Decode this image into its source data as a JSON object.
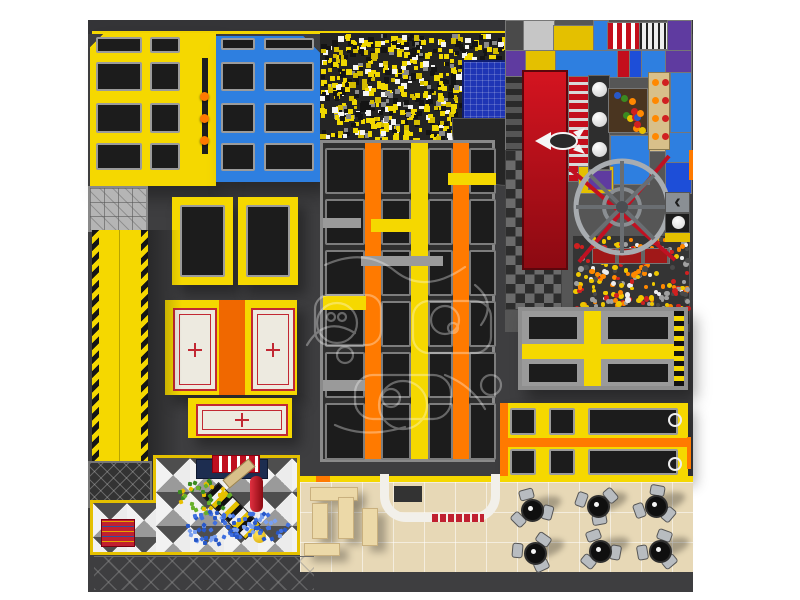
{
  "scene": {
    "title": "Indoor trampoline park with kids soft-play — top view 3D render",
    "canvas": {
      "width": 800,
      "height": 600,
      "background": "#ffffff"
    },
    "watermark": {
      "present": true,
      "description": "faint white outline cartoon logo overlay"
    }
  },
  "icons": {
    "chevron_left": "‹"
  },
  "palette": {
    "yellow": "#f5d800",
    "yellowDeep": "#e4c000",
    "orange": "#ff7a00",
    "orangeDeep": "#f06800",
    "blue": "#2e7fe0",
    "blueDeep": "#1d4ed8",
    "navy": "#1f35b5",
    "purple": "#5f3ba0",
    "red": "#c40e1c",
    "redDark": "#a01818",
    "silver": "#c6c6c6",
    "gray": "#9a9a9a",
    "grayLight": "#b5b5b5",
    "dim": "#4a4a4a",
    "bed": "#1c1c1c",
    "floor": "#3e3e40",
    "floorDark": "#343437",
    "beige": "#e7d8b6",
    "court": "#edeae0",
    "courtLine": "#c22833",
    "tan": "#d8c08a",
    "benchTan": "#ecd9a8",
    "white": "#f5f5f5"
  },
  "zones": {
    "yellow_block": {
      "label": "yellow wall trampolines",
      "x": 90,
      "y": 33,
      "w": 126,
      "h": 153,
      "cols": [
        [
          6,
          46
        ],
        [
          60,
          30
        ]
      ],
      "rows": [
        [
          4,
          16
        ],
        [
          29,
          29
        ],
        [
          70,
          30
        ],
        [
          110,
          27
        ]
      ]
    },
    "blue_block": {
      "label": "blue wall trampolines",
      "x": 216,
      "y": 36,
      "w": 104,
      "h": 146,
      "cols": [
        [
          5,
          34
        ],
        [
          48,
          50
        ]
      ],
      "rows": [
        [
          2,
          12
        ],
        [
          26,
          29
        ],
        [
          67,
          30
        ],
        [
          107,
          28
        ]
      ]
    },
    "orange_balls": [
      [
        200,
        92
      ],
      [
        200,
        114
      ],
      [
        200,
        136
      ]
    ],
    "foam_pit": {
      "label": "foam cube pit",
      "cube_count": 780,
      "cube_colors": [
        "#f0d800",
        "#d4bc00",
        "#141414",
        "#f5f5f5",
        "#8a8a8a"
      ],
      "cube_weights": [
        0.36,
        0.14,
        0.3,
        0.13,
        0.07
      ]
    },
    "main_court": {
      "label": "main trampoline court",
      "columns": 4,
      "rows": 6,
      "col_rects": [
        [
          2,
          40
        ],
        [
          58,
          30
        ],
        [
          105,
          25
        ],
        [
          146,
          27
        ]
      ],
      "beams": [
        [
          42,
          16,
          "orange"
        ],
        [
          88,
          17,
          "yellow"
        ],
        [
          130,
          16,
          "orange"
        ]
      ],
      "row_ys": [
        [
          5,
          46
        ],
        [
          56,
          46
        ],
        [
          107,
          46
        ],
        [
          158,
          46
        ],
        [
          209,
          46
        ],
        [
          260,
          57
        ]
      ],
      "pads": [
        [
          0,
          75,
          38,
          10,
          "gray"
        ],
        [
          48,
          76,
          52,
          13,
          "yellow"
        ],
        [
          38,
          113,
          82,
          10,
          "gray"
        ],
        [
          0,
          153,
          43,
          14,
          "yellow"
        ],
        [
          0,
          237,
          42,
          11,
          "gray"
        ],
        [
          125,
          30,
          48,
          12,
          "yellow"
        ]
      ]
    },
    "playground": {
      "label": "kids soft-play structure",
      "tiles": [
        [
          0,
          0,
          18,
          30,
          "dim"
        ],
        [
          18,
          0,
          30,
          30,
          "silver"
        ],
        [
          48,
          5,
          40,
          27,
          "yellowDeep"
        ],
        [
          88,
          0,
          14,
          30,
          "blue"
        ],
        [
          102,
          2,
          32,
          26,
          "stripe-red"
        ],
        [
          134,
          2,
          28,
          26,
          "stripe-dot"
        ],
        [
          162,
          0,
          23,
          30,
          "purple"
        ],
        [
          0,
          30,
          20,
          26,
          "purple"
        ],
        [
          20,
          30,
          30,
          26,
          "yellowDeep"
        ],
        [
          50,
          30,
          62,
          26,
          "blue"
        ],
        [
          112,
          30,
          12,
          26,
          "red"
        ],
        [
          124,
          30,
          12,
          26,
          "blueDeep"
        ],
        [
          136,
          30,
          24,
          26,
          "blue"
        ],
        [
          160,
          30,
          25,
          26,
          "purple"
        ],
        [
          0,
          56,
          17,
          204,
          "stripe-roller"
        ],
        [
          63,
          56,
          20,
          104,
          "stripe-redwhite"
        ],
        [
          143,
          52,
          22,
          78,
          "tan"
        ],
        [
          165,
          52,
          20,
          60,
          "blue"
        ],
        [
          105,
          115,
          38,
          48,
          "blue"
        ],
        [
          73,
          146,
          34,
          26,
          "yellowDeep"
        ],
        [
          83,
          150,
          22,
          18,
          "purple"
        ],
        [
          160,
          112,
          25,
          30,
          "blue"
        ],
        [
          160,
          142,
          25,
          30,
          "blueDeep"
        ]
      ],
      "ball_panel_dots": 12,
      "abacus_rows": 4,
      "ball_pit": {
        "count": 250,
        "colors": [
          "#f0c800",
          "#ff8800",
          "#d02020",
          "#a0a0a0",
          "#4a4a4a",
          "#eeeeee"
        ],
        "weights": [
          0.22,
          0.2,
          0.15,
          0.18,
          0.15,
          0.1
        ]
      }
    },
    "dodgeball_courts": {
      "label": "dodgeball courts with red line markings",
      "count": 3
    },
    "cafe": {
      "label": "cafe seating area",
      "chairs_per_table": 3,
      "tables": [
        {
          "cx": 530,
          "cy": 508,
          "rot": 15
        },
        {
          "cx": 596,
          "cy": 504,
          "rot": 80
        },
        {
          "cx": 654,
          "cy": 504,
          "rot": 40
        },
        {
          "cx": 533,
          "cy": 551,
          "rot": 65
        },
        {
          "cx": 598,
          "cy": 549,
          "rot": 10
        },
        {
          "cx": 658,
          "cy": 549,
          "rot": 50
        }
      ]
    },
    "toddler": {
      "label": "toddler soft-play zone on diamond checker floor",
      "clusters": [
        {
          "cx": 205,
          "cy": 495,
          "rx": 28,
          "ry": 16,
          "count": 38,
          "colors": [
            "#3a8a20",
            "#67b02a",
            "#e8c000"
          ]
        },
        {
          "cx": 213,
          "cy": 527,
          "rx": 30,
          "ry": 18,
          "count": 50,
          "colors": [
            "#2858c8",
            "#4070e0",
            "#7aa0f0"
          ]
        },
        {
          "cx": 262,
          "cy": 524,
          "rx": 24,
          "ry": 15,
          "count": 34,
          "colors": [
            "#2858c8",
            "#4070e0",
            "#7aa0f0"
          ]
        }
      ]
    }
  }
}
